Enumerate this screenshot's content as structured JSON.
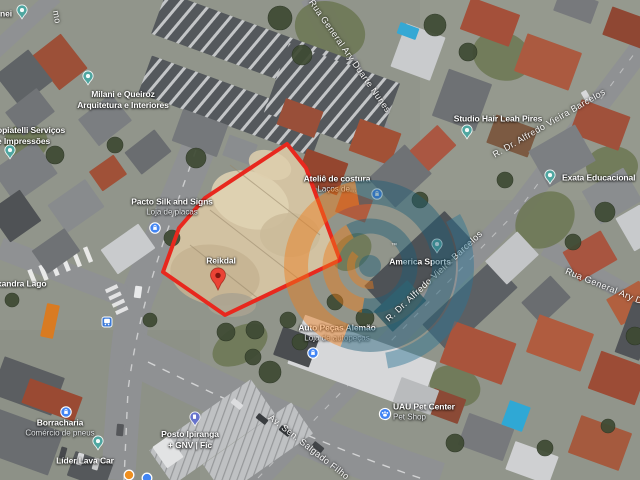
{
  "map": {
    "view_type": "satellite",
    "lot": {
      "outline_color": "#e8281e",
      "fill_color": "#d2c2a2",
      "points": [
        [
          287,
          144
        ],
        [
          306,
          168
        ],
        [
          340,
          260
        ],
        [
          225,
          315
        ],
        [
          163,
          272
        ],
        [
          179,
          228
        ],
        [
          205,
          198
        ]
      ]
    },
    "watermark": {
      "orange": "#f07d1a",
      "teal": "#1f5f78",
      "teal_light": "#2a7496",
      "opacity": 0.45,
      "trademark": "™"
    },
    "pin_colors": {
      "poi": "#4fa6a0",
      "shop": "#4285f4",
      "dest": "#ea4335",
      "dest_inner": "#7f1710",
      "fuel": "#6673cc",
      "transit": "#3d7bd9",
      "dot_orange": "#ef8f1f",
      "dot_blue": "#4285f4"
    },
    "street_labels": [
      {
        "text": "Rua General Ary Duarte Nunes",
        "x": 350,
        "y": 56,
        "rotation": 55
      },
      {
        "text": "R. Dr. Alfredo Vieira Barcelos",
        "x": 549,
        "y": 123,
        "rotation": -30
      },
      {
        "text": "R. Dr. Alfredo Vieira Barcelos",
        "x": 434,
        "y": 276,
        "rotation": -43
      },
      {
        "text": "Rua General Ary D",
        "x": 604,
        "y": 286,
        "rotation": 22
      },
      {
        "text": "Av. Sen. Salgado Filho",
        "x": 309,
        "y": 447,
        "rotation": 38
      },
      {
        "text": "mo",
        "x": 57,
        "y": 17,
        "rotation": 80
      }
    ],
    "place_labels": [
      {
        "name": "partial-poi",
        "lines": [
          "nei"
        ],
        "x": 0,
        "y": 14,
        "align": "left"
      },
      {
        "name": "milani-queiroz",
        "lines": [
          "Milani e Queiroz",
          "Arquitetura e Interiores"
        ],
        "x": 123,
        "y": 100,
        "align": "center"
      },
      {
        "name": "copiatelli",
        "lines": [
          "opiatelli Serviços",
          "e Impressões"
        ],
        "x": -3,
        "y": 136,
        "align": "left"
      },
      {
        "name": "pacto-silk",
        "lines": [
          "Pacto Silk and Signs"
        ],
        "sub": "Loja de placas",
        "x": 172,
        "y": 207,
        "align": "center"
      },
      {
        "name": "atelie-costura",
        "lines": [
          "Ateliê de costura"
        ],
        "sub": "Laços de...",
        "x": 337,
        "y": 184,
        "align": "center"
      },
      {
        "name": "studio-hair",
        "lines": [
          "Studio Hair Leah Pires"
        ],
        "x": 498,
        "y": 119,
        "align": "center"
      },
      {
        "name": "exata-educacional",
        "lines": [
          "Exata Educacional"
        ],
        "x": 562,
        "y": 178,
        "align": "left"
      },
      {
        "name": "america-sports",
        "lines": [
          "America Sports"
        ],
        "x": 420,
        "y": 262,
        "align": "center"
      },
      {
        "name": "reikdal",
        "lines": [
          "Reikdal"
        ],
        "x": 221,
        "y": 261,
        "align": "center"
      },
      {
        "name": "auto-pecas-alemao",
        "lines": [
          "Auto Peças Alemão"
        ],
        "sub": "Loja de autopeças",
        "x": 337,
        "y": 333,
        "align": "center"
      },
      {
        "name": "uau-pet-center",
        "lines": [
          "UAU Pet Center"
        ],
        "sub": "Pet Shop",
        "x": 393,
        "y": 412,
        "align": "left"
      },
      {
        "name": "borracharia",
        "lines": [
          "Borracharia"
        ],
        "sub": "Comércio de pneus",
        "x": 60,
        "y": 428,
        "align": "center"
      },
      {
        "name": "lider-lava-car",
        "lines": [
          "Líder Lava Car"
        ],
        "x": 85,
        "y": 461,
        "align": "center"
      },
      {
        "name": "posto-ipiranga",
        "lines": [
          "Posto Ipiranga",
          "+ GNV | Fic"
        ],
        "x": 190,
        "y": 440,
        "align": "center"
      },
      {
        "name": "xandra-lago",
        "lines": [
          "xandra Lago"
        ],
        "x": -3,
        "y": 284,
        "align": "left"
      }
    ],
    "pins": [
      {
        "name": "corner-poi-pin",
        "type": "poi",
        "x": 22,
        "y": 12
      },
      {
        "name": "milani-pin",
        "type": "poi",
        "x": 88,
        "y": 78
      },
      {
        "name": "left-edge-poi-pin",
        "type": "poi",
        "x": 10,
        "y": 152
      },
      {
        "name": "pacto-shop-pin",
        "type": "shop",
        "x": 155,
        "y": 228
      },
      {
        "name": "studio-hair-pin",
        "type": "poi",
        "x": 467,
        "y": 132
      },
      {
        "name": "exata-pin",
        "type": "poi",
        "x": 550,
        "y": 177
      },
      {
        "name": "atelie-shop-pin",
        "type": "shop",
        "x": 377,
        "y": 194
      },
      {
        "name": "america-sports-pin",
        "type": "poi",
        "x": 437,
        "y": 246
      },
      {
        "name": "reikdal-destination-pin",
        "type": "dest",
        "x": 218,
        "y": 279
      },
      {
        "name": "auto-pecas-pin",
        "type": "shop",
        "x": 313,
        "y": 353
      },
      {
        "name": "uau-pet-pin",
        "type": "pet",
        "x": 385,
        "y": 414
      },
      {
        "name": "borracharia-pin",
        "type": "shop",
        "x": 66,
        "y": 412
      },
      {
        "name": "lava-car-pin",
        "type": "poi",
        "x": 98,
        "y": 443
      },
      {
        "name": "posto-fuel-pin",
        "type": "fuel",
        "x": 195,
        "y": 419
      },
      {
        "name": "bus-stop-icon",
        "type": "transit",
        "x": 107,
        "y": 322
      },
      {
        "name": "orange-dot-pin",
        "type": "dot_orange",
        "x": 129,
        "y": 475
      },
      {
        "name": "blue-dot-pin",
        "type": "dot_blue",
        "x": 147,
        "y": 478
      }
    ]
  }
}
